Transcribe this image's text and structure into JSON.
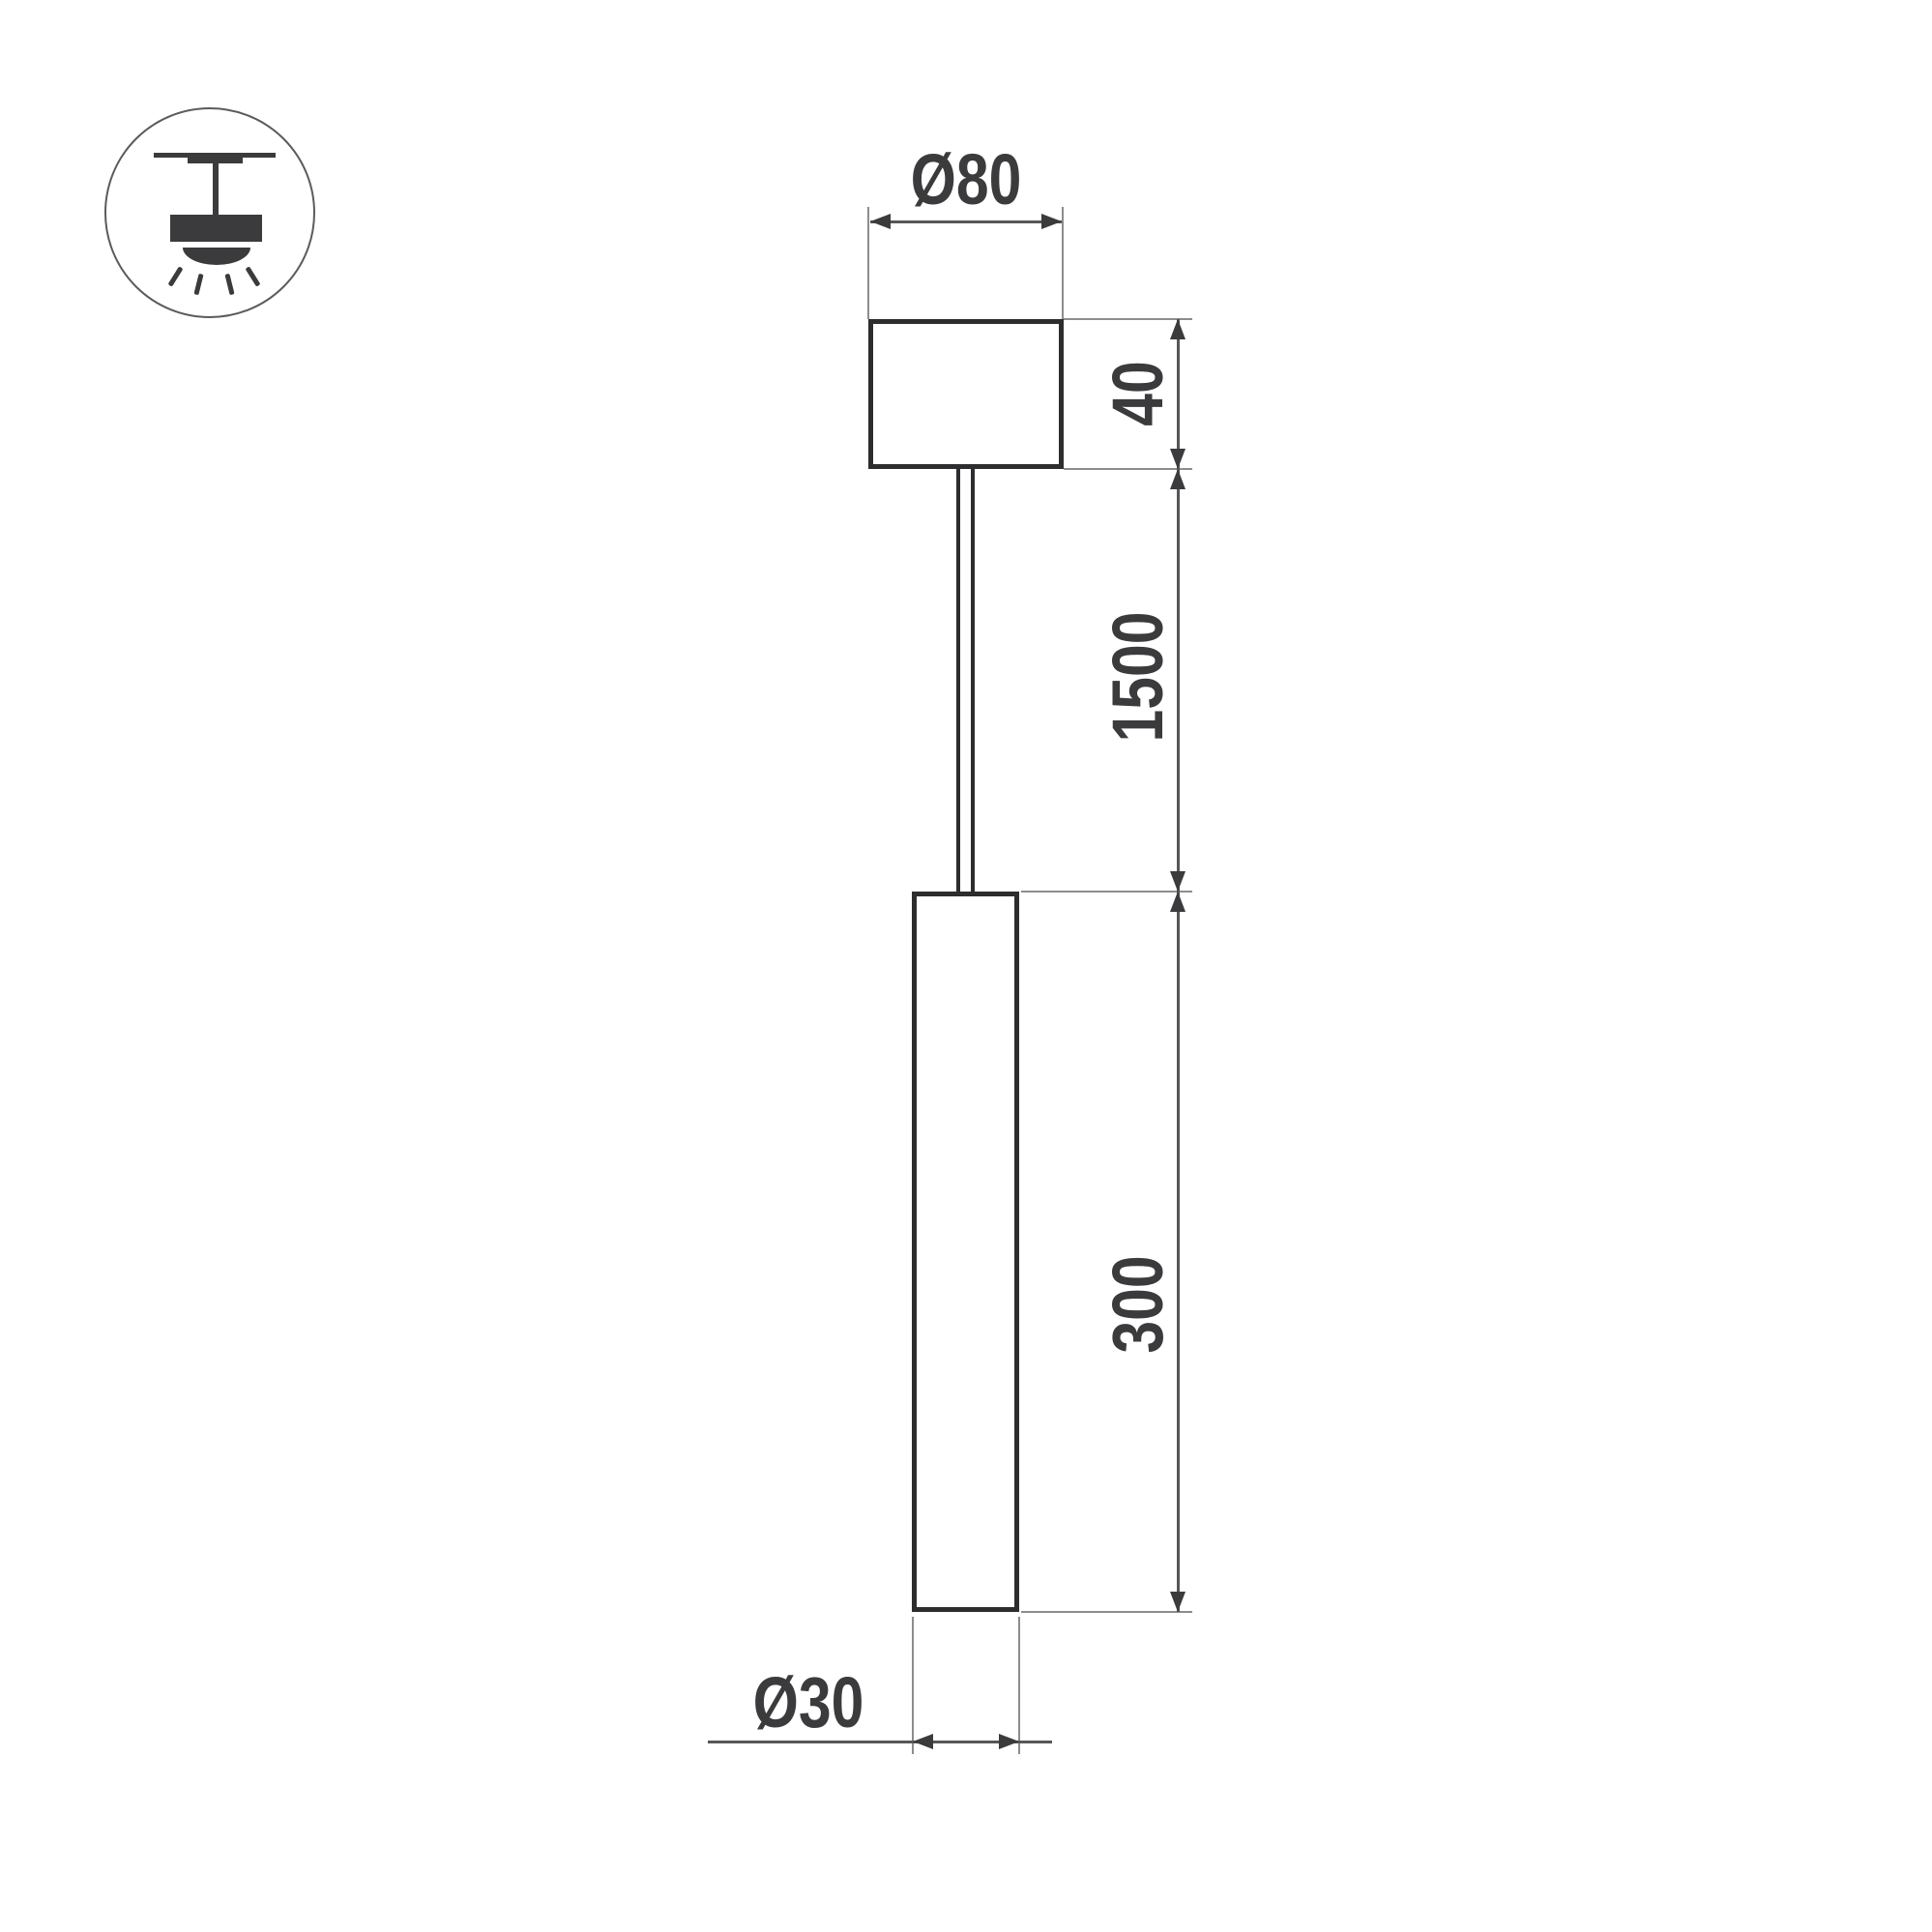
{
  "drawing": {
    "title": "Pendant luminaire dimension drawing",
    "icon": "ceiling-pendant-mount",
    "dimensions": {
      "canopy_diameter": "Ø80",
      "canopy_height": "40",
      "suspension_length": "1500",
      "tube_length": "300",
      "tube_diameter": "Ø30"
    },
    "units": "mm",
    "colors": {
      "background": "#ffffff",
      "outline": "#2d2d2f",
      "dimension_line": "#57575a",
      "extension_line": "#8d8d8f",
      "annotation": "#3b3b3d"
    }
  }
}
